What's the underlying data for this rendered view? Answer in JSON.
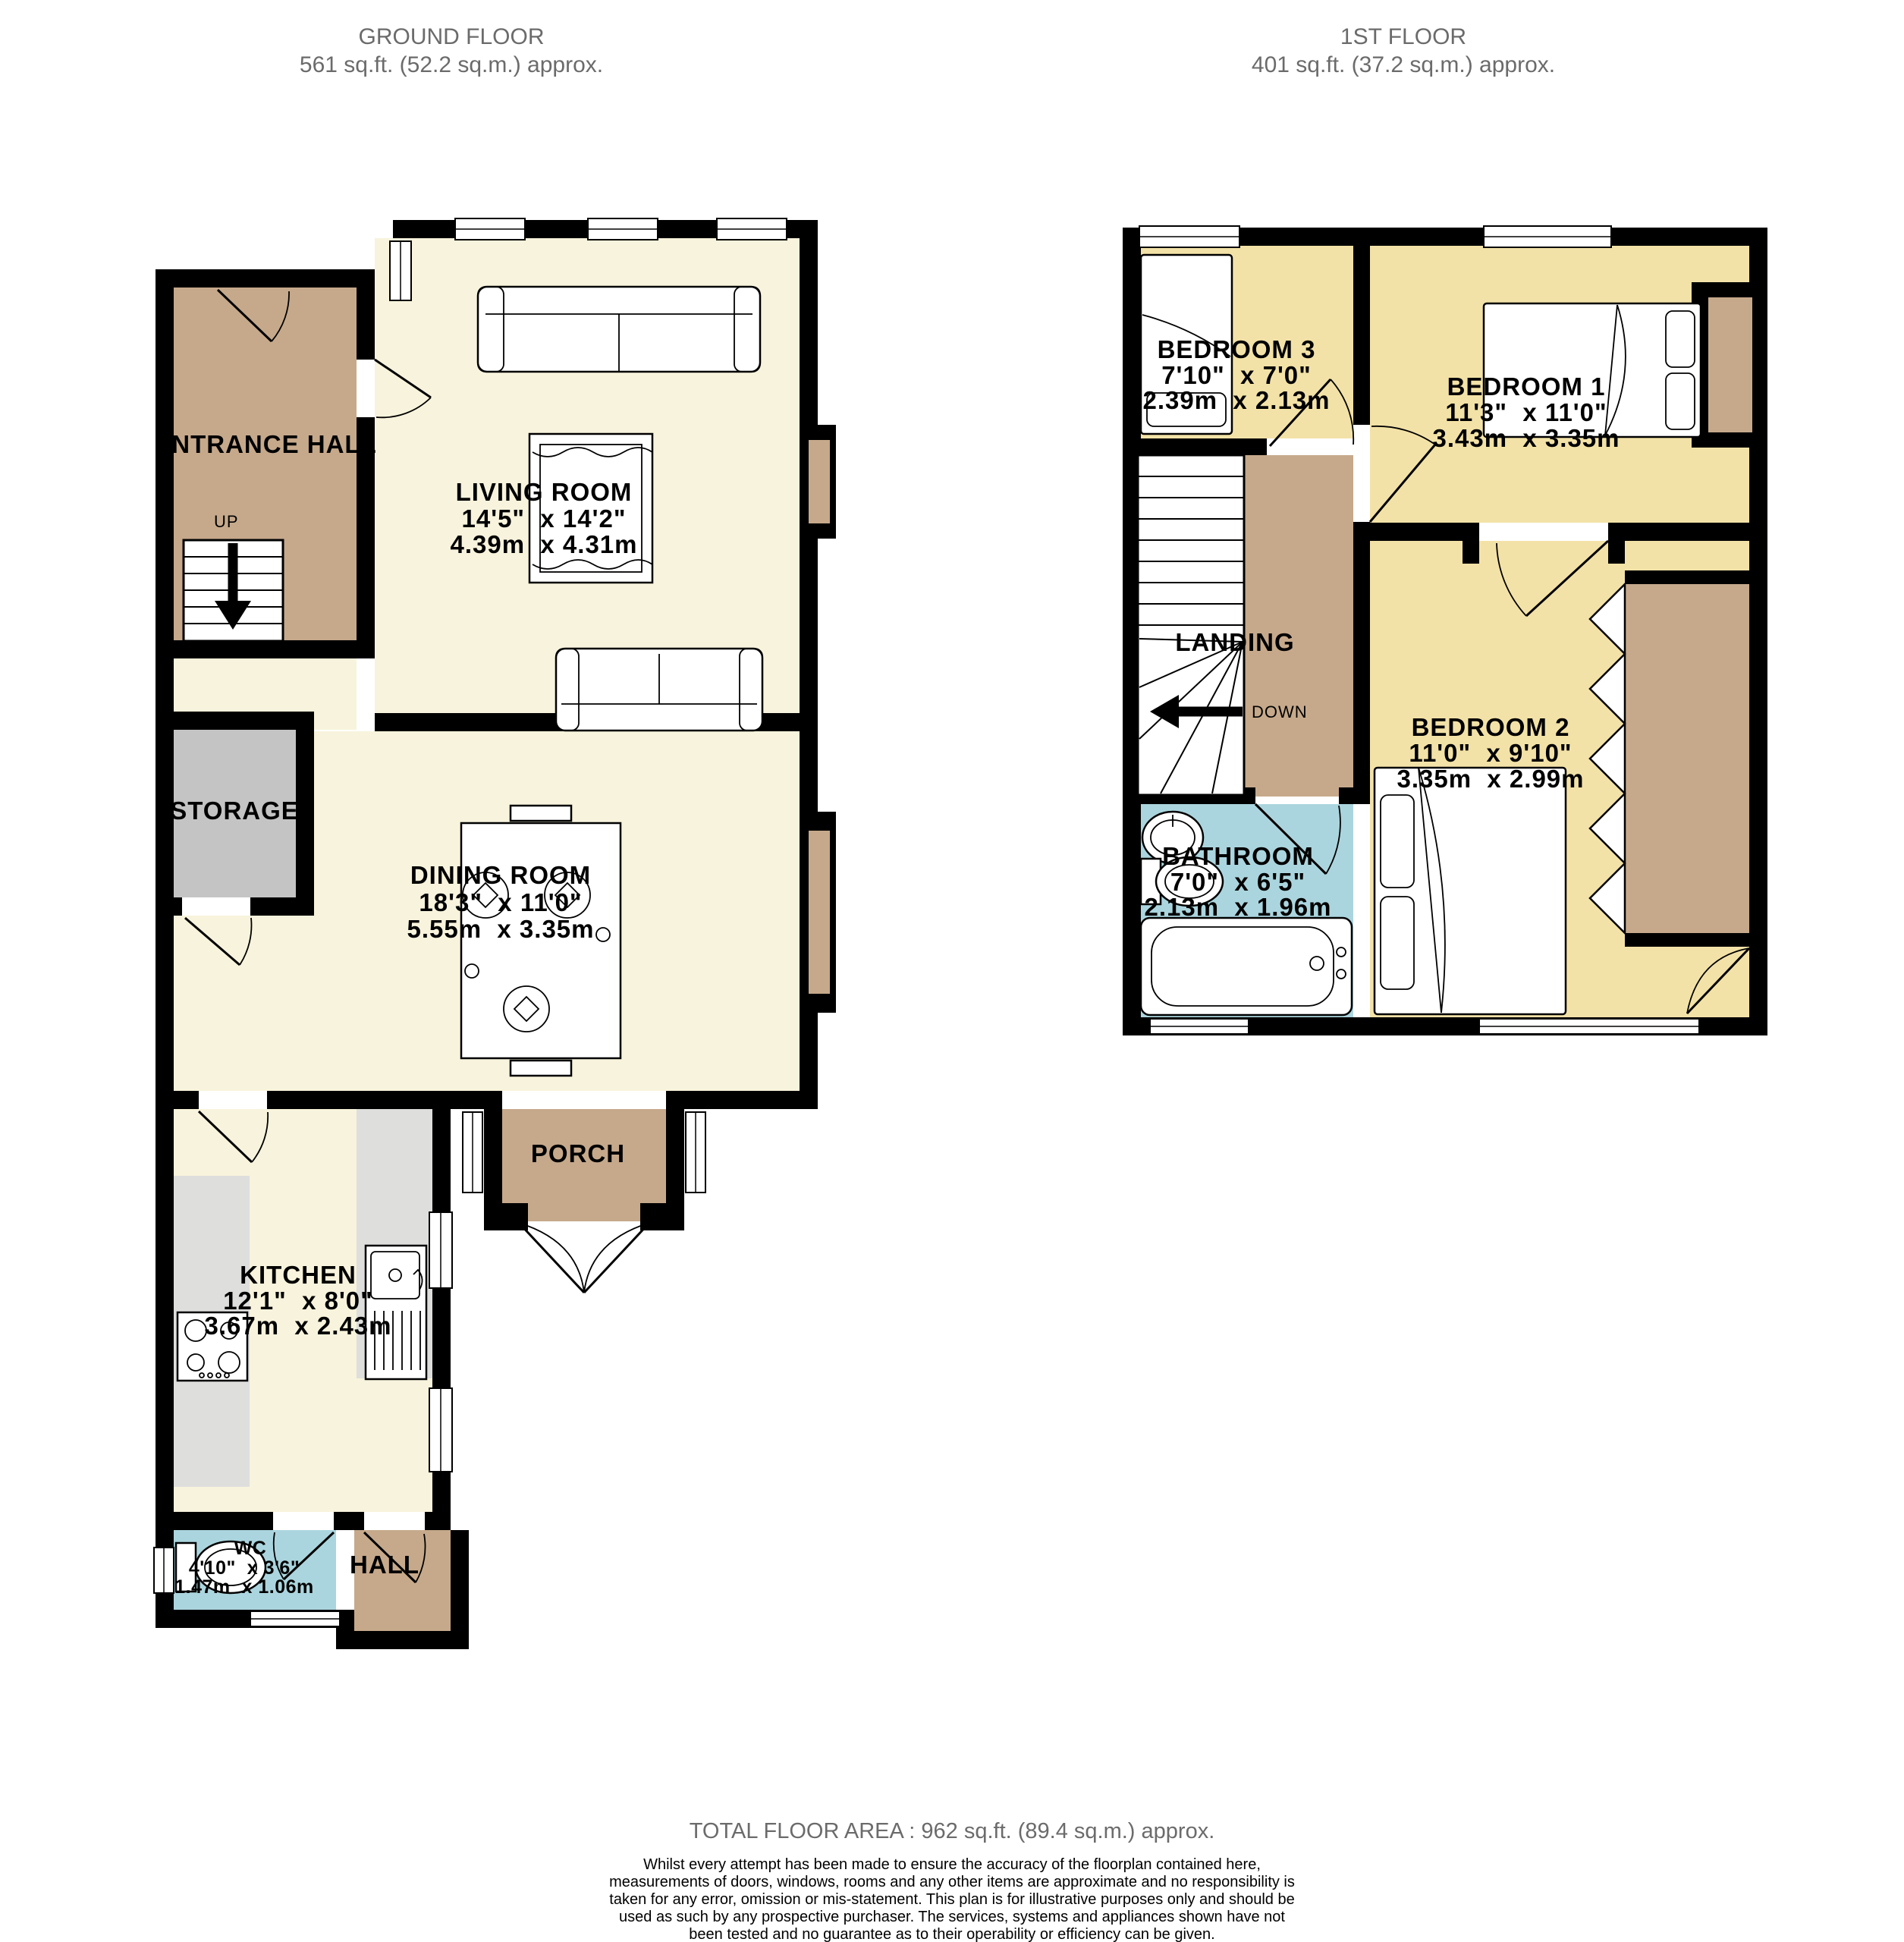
{
  "header": {
    "ground": {
      "title": "GROUND FLOOR",
      "area": "561 sq.ft. (52.2 sq.m.) approx."
    },
    "first": {
      "title": "1ST FLOOR",
      "area": "401 sq.ft. (37.2 sq.m.) approx."
    }
  },
  "ground_floor": {
    "entrance_hall": {
      "name": "ENTRANCE HALL"
    },
    "stairs": {
      "up": "UP"
    },
    "living_room": {
      "name": "LIVING ROOM",
      "imperial": "14'5\"  x 14'2\"",
      "metric": "4.39m  x 4.31m"
    },
    "storage": {
      "name": "STORAGE"
    },
    "dining_room": {
      "name": "DINING ROOM",
      "imperial": "18'3\"  x 11'0\"",
      "metric": "5.55m  x 3.35m"
    },
    "porch": {
      "name": "PORCH"
    },
    "kitchen": {
      "name": "KITCHEN",
      "imperial": "12'1\"  x 8'0\"",
      "metric": "3.67m  x 2.43m"
    },
    "wc": {
      "name": "WC",
      "imperial": "4'10\"  x 3'6\"",
      "metric": "1.47m  x 1.06m"
    },
    "hall": {
      "name": "HALL"
    }
  },
  "first_floor": {
    "bedroom3": {
      "name": "BEDROOM 3",
      "imperial": "7'10\"  x 7'0\"",
      "metric": "2.39m  x 2.13m"
    },
    "bedroom1": {
      "name": "BEDROOM 1",
      "imperial": "11'3\"  x 11'0\"",
      "metric": "3.43m  x 3.35m"
    },
    "landing": {
      "name": "LANDING",
      "down": "DOWN"
    },
    "bathroom": {
      "name": "BATHROOM",
      "imperial": "7'0\"  x 6'5\"",
      "metric": "2.13m  x 1.96m"
    },
    "bedroom2": {
      "name": "BEDROOM 2",
      "imperial": "11'0\"  x 9'10\"",
      "metric": "3.35m  x 2.99m"
    }
  },
  "footer": {
    "total": "TOTAL FLOOR AREA : 962 sq.ft. (89.4 sq.m.) approx.",
    "disclaimer": "Whilst every attempt has been made to ensure the accuracy of the floorplan contained here, measurements of doors, windows, rooms and any other items are approximate and no responsibility is taken for any error, omission or mis-statement. This plan is for illustrative purposes only and should be used as such by any prospective purchaser. The services, systems and appliances shown have not been tested and no guarantee as to their operability or efficiency can be given.",
    "credit": "Made with Metropix ©2026"
  },
  "colors": {
    "wall": "#000000",
    "ground_room": "#f8f3dc",
    "bedroom": "#f3e2a7",
    "hallway_brown": "#c6a98b",
    "wet_room_blue": "#abd5de",
    "storage_gray": "#c4c4c4",
    "counter_gray": "#dededd",
    "header_text": "#6b6b6b"
  }
}
